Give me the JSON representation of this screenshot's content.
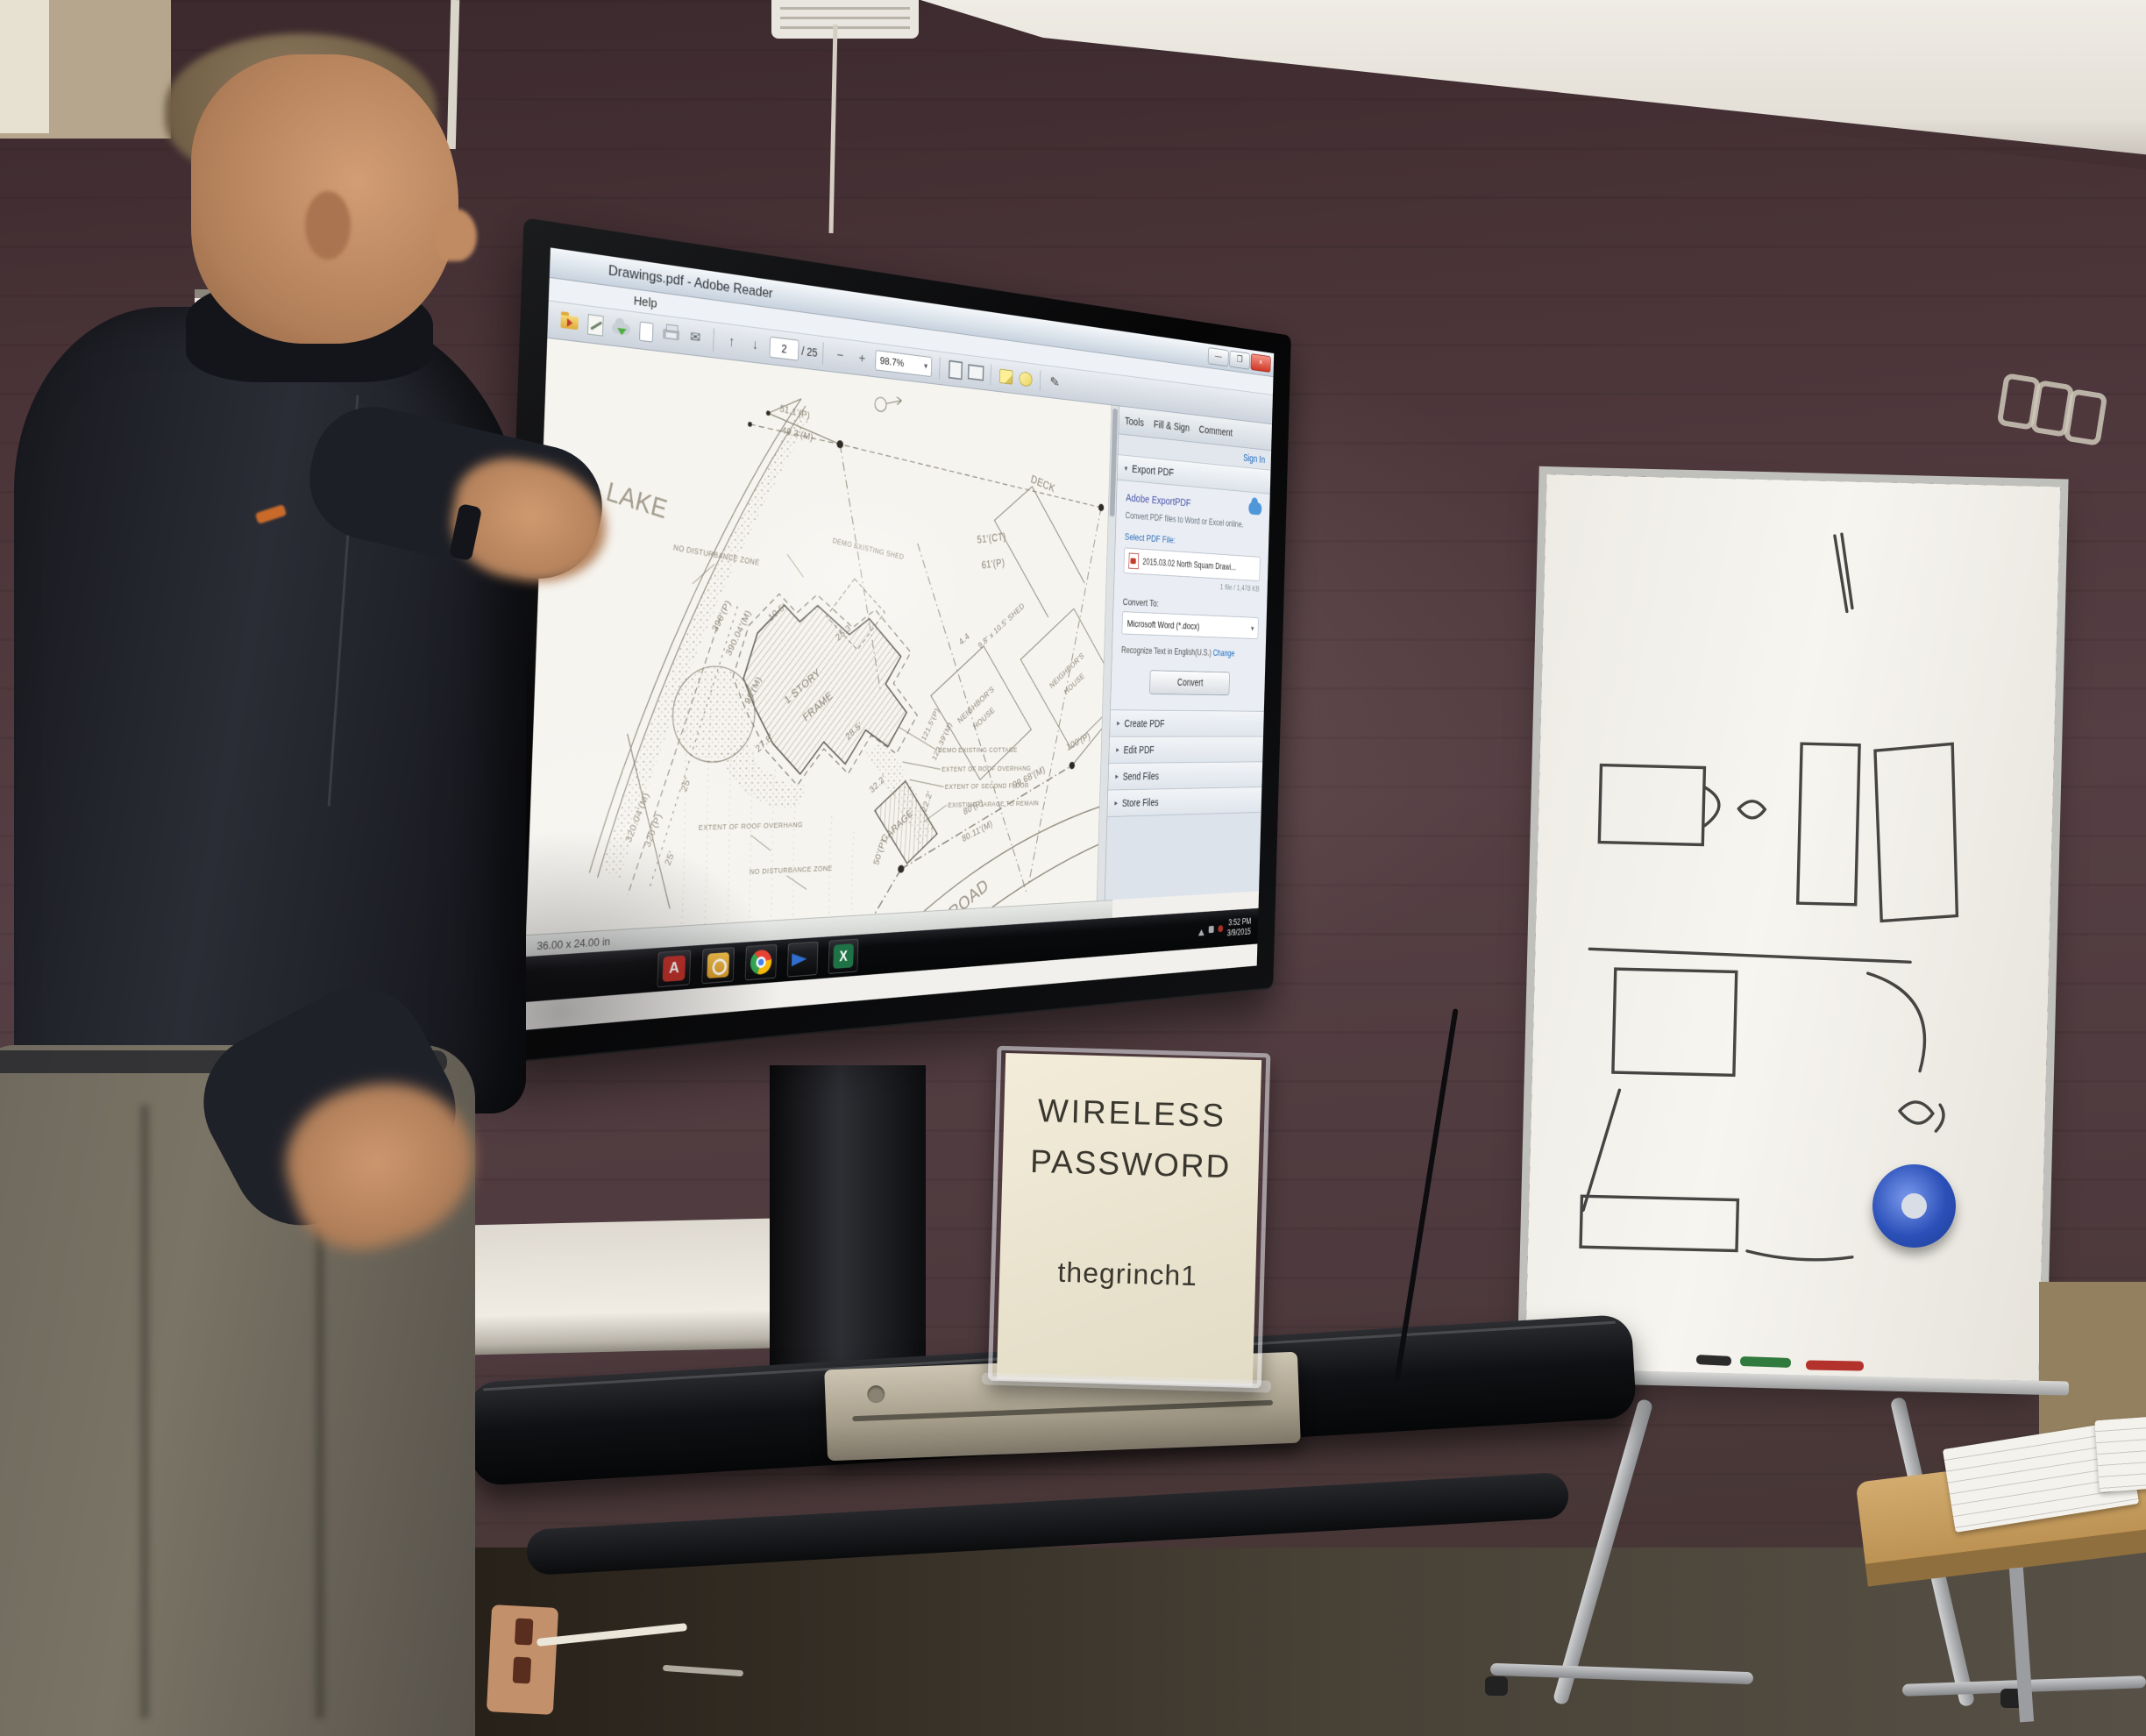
{
  "sign": {
    "line1": "WIRELESS",
    "line2": "PASSWORD",
    "password": "thegrinch1"
  },
  "reader": {
    "window_title": "Drawings.pdf - Adobe Reader",
    "menu": {
      "help": "Help"
    },
    "window_controls": {
      "minimize": "—",
      "maximize": "❐",
      "close": "×"
    },
    "toolbar": {
      "page_current": "2",
      "page_total": "/ 25",
      "zoom_level": "98.7%"
    },
    "tabs": {
      "tools": "Tools",
      "fill_sign": "Fill & Sign",
      "comment": "Comment",
      "sign_in": "Sign In"
    },
    "export_panel": {
      "title": "Export PDF",
      "product_name": "Adobe ExportPDF",
      "description": "Convert PDF files to Word or Excel online.",
      "select_file_label": "Select PDF File:",
      "file_name": "2015.03.02 North Squam Drawi...",
      "file_meta": "1 file / 1,478 KB",
      "convert_to_label": "Convert To:",
      "convert_format": "Microsoft Word (*.docx)",
      "recognize_text": "Recognize Text in English(U.S.)",
      "change_link": "Change",
      "convert_button": "Convert"
    },
    "collapsed_sections": [
      "Create PDF",
      "Edit PDF",
      "Send Files",
      "Store Files"
    ],
    "status_bar": {
      "page_size": "36.00 x 24.00 in"
    },
    "taskbar": {
      "icons": [
        "adobe-reader",
        "outlook",
        "chrome",
        "smart-notebook",
        "excel"
      ],
      "clock_time": "3:52 PM",
      "clock_date": "3/9/2015"
    }
  },
  "site_plan": {
    "lake": "LAKE",
    "road": "ROAD",
    "deck": "DECK",
    "neighbors_house_line1": "NEIGHBOR'S",
    "neighbors_house_line2": "HOUSE",
    "house_line1": "1 STORY",
    "house_line2": "FRAME",
    "garage": "GARAGE",
    "shed_label": "9.8' x 10.5' SHED",
    "demo_shed": "DEMO EXISTING SHED",
    "demo_cottage": "DEMO EXISTING COTTAGE",
    "extent_roof_overhang": "EXTENT OF ROOF OVERHANG",
    "extent_roof_overhang_2": "EXTENT OF ROOF OVERHANG",
    "extent_second_floor": "EXTENT OF SECOND FLOOR",
    "existing_garage_remain": "EXISTING GARAGE TO REMAIN",
    "no_disturbance_zone": "NO DISTURBANCE ZONE",
    "no_disturbance_zone_2": "NO DISTURBANCE ZONE",
    "dims": {
      "d390p": "390'(P)",
      "d390m": "390.04'(M)",
      "d98m": "98'(M)",
      "d511p": "51.1'(P)",
      "d493m": "49.3'(M)",
      "d51ct": "51'(CT)",
      "d61p": "61'(P)",
      "d44": "4.4",
      "d1215p": "121.5'(P)",
      "d12239m": "122.39'(M)",
      "d105": "10.5'",
      "d253": "25.3'",
      "d278": "27.8'",
      "d285": "28.5'",
      "d322": "32.2'",
      "d222": "22.2'",
      "d100p": "100'(P)",
      "d9968m": "99.68'(M)",
      "d80p": "80'(P)",
      "d8011m": "80.11'(M)",
      "d50p": "50'(P)",
      "d320m": "320.04'(M)",
      "d320p": "320'(P)",
      "d25a": "25'",
      "d25b": "25'"
    }
  }
}
